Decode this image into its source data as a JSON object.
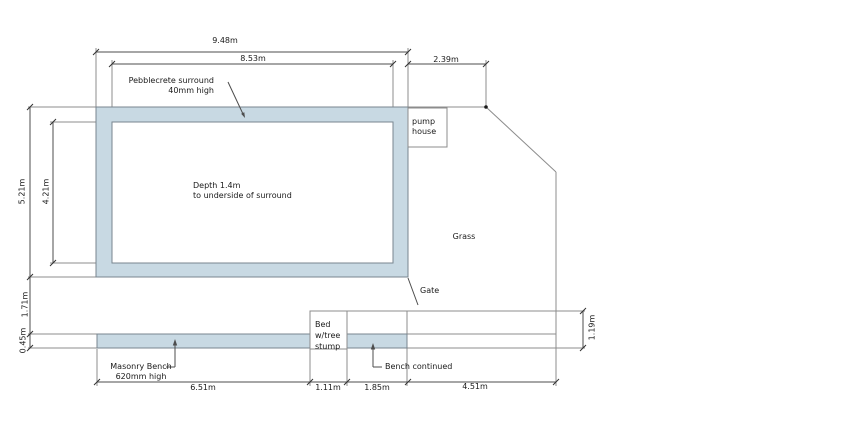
{
  "drawing": {
    "dimensions": {
      "outer_width": "9.48m",
      "inner_width": "8.53m",
      "side_width": "2.39m",
      "outer_height": "5.21m",
      "inner_height": "4.21m",
      "gap_height": "1.71m",
      "bench_depth": "0.45m",
      "bench_offset": "1.19m",
      "bench_length": "6.51m",
      "bed_width": "1.11m",
      "bench_continued_length": "1.85m",
      "grass_width": "4.51m"
    },
    "labels": {
      "surround_line1": "Pebblecrete surround",
      "surround_line2": "40mm high",
      "pump_line1": "pump",
      "pump_line2": "house",
      "depth_line1": "Depth 1.4m",
      "depth_line2": "to underside of surround",
      "grass": "Grass",
      "gate": "Gate",
      "bed_line1": "Bed",
      "bed_line2": "w/tree",
      "bed_line3": "stump",
      "bench_line1": "Masonry Bench",
      "bench_line2": "620mm high",
      "bench_continued": "Bench continued"
    },
    "colors": {
      "surround_fill": "#c8d9e3",
      "pool_outline": "#78858f",
      "line": "#8c8c8c",
      "dimension": "#4d4d4d",
      "text": "#1a1a1a"
    }
  }
}
